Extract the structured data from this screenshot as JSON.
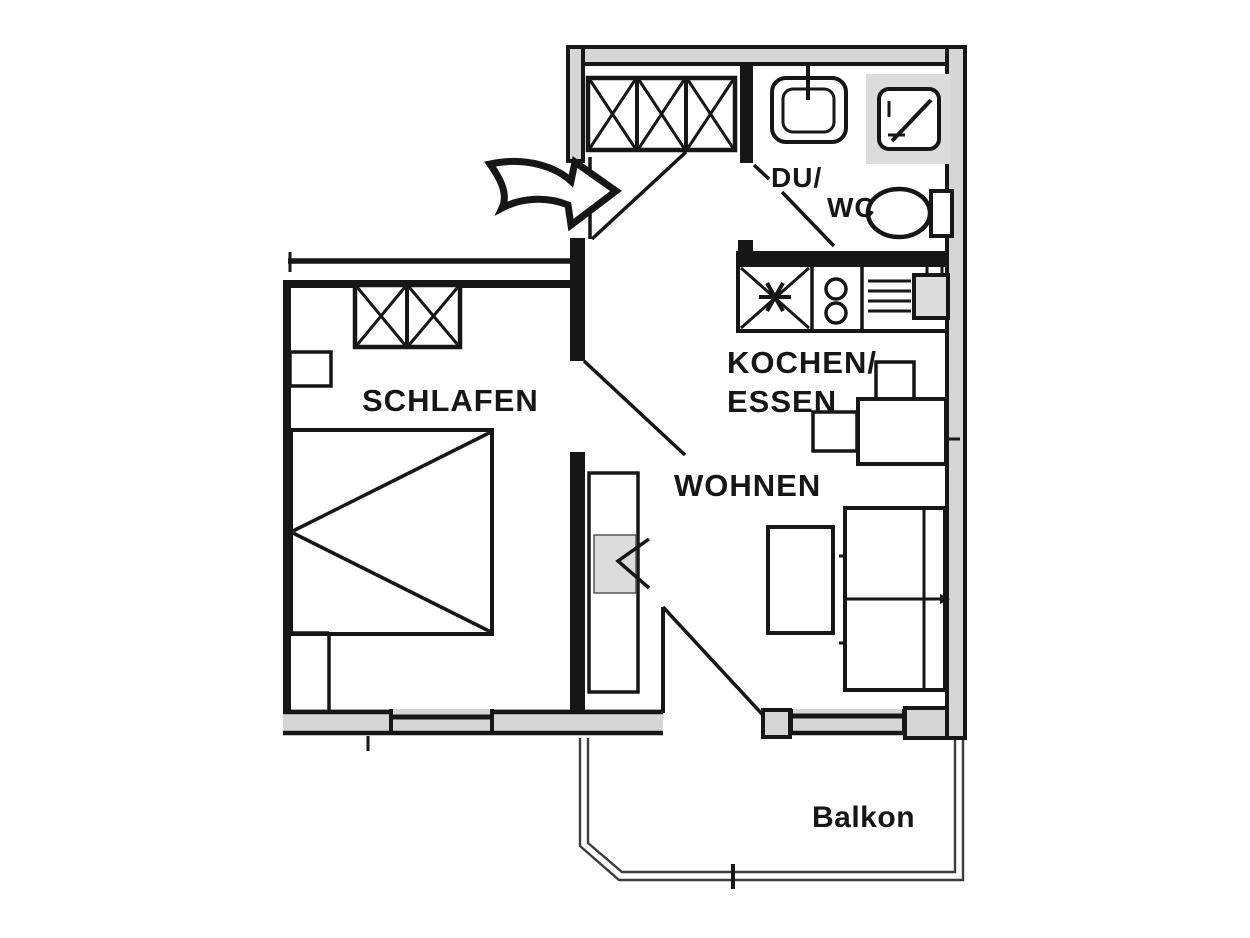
{
  "colors": {
    "ink": "#161616",
    "wall_fill": "#d6d6d6",
    "fixture_fill": "#dcdcdc",
    "rail": "#3c3c3c",
    "background": "#ffffff"
  },
  "labels": {
    "bedroom": "SCHLAFEN",
    "living_room": "WOHNEN",
    "kitchen_line1": "KOCHEN/",
    "kitchen_line2": "ESSEN",
    "bathroom_line1": "DU/",
    "bathroom_line2": "WC",
    "balcony": "Balkon"
  },
  "icons": {
    "entry_arrow": "curved-arrow-right",
    "hall_wardrobe": "wardrobe-three-crossed-sections",
    "bedroom_wardrobe": "wardrobe-two-crossed-sections",
    "bed": "double-bed-with-diagonals",
    "washbasin": "basin-with-faucet",
    "shower": "square-tray-with-diagonal",
    "toilet": "wc-bowl-with-cistern",
    "kitchen_sink_unit": "crossed-box-with-asterisk",
    "cooktop": "two-burner-hob",
    "drainboard_sink": "drainboard-lines-with-basin",
    "dining_set": "table-with-two-chairs",
    "sofa": "two-seat-sofa",
    "coffee_table": "rectangular-table",
    "tv_sideboard": "sideboard-with-tv-chevron"
  }
}
